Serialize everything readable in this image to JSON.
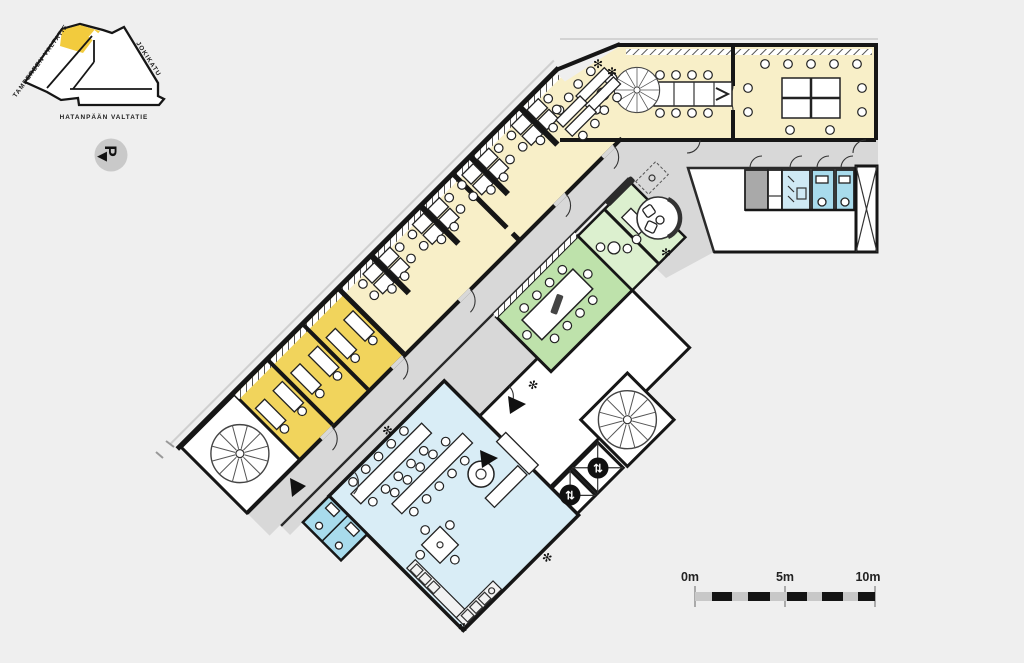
{
  "colors": {
    "background": "#EFEFEF",
    "wall": "#161616",
    "office_pale": "#F8EFC8",
    "office_dark": "#F1D45C",
    "corridor": "#D8D8D8",
    "meeting_green": "#BEE2AB",
    "booth_green": "#DCF0CF",
    "break_blue": "#D9EDF6",
    "wc_blue": "#A8DBEC",
    "wc_pale": "#CFE9F4",
    "service_dark": "#A9A9A9",
    "scale_gray": "#C8C8C8",
    "site_highlight": "#F2CB3D",
    "badge_gray": "#C9C9C9"
  },
  "site_map": {
    "street_top": "TAMPEREEN VALTATIE",
    "street_right": "JOKIKATU",
    "street_bottom": "HATANPÄÄN VALTATIE"
  },
  "parking": {
    "label": "P",
    "arrow": "◀"
  },
  "scale_bar": {
    "zero": "0m",
    "mid": "5m",
    "max": "10m"
  },
  "icons": {
    "elevator": "⇅",
    "plant": "✻"
  }
}
